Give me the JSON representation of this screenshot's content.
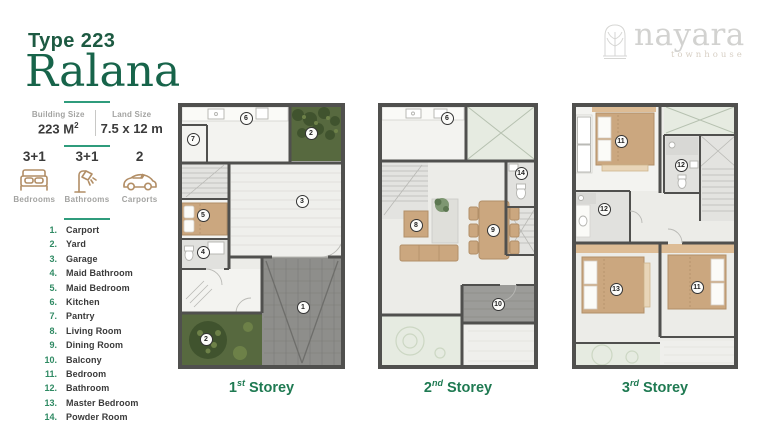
{
  "header": {
    "type_label": "Type 223",
    "name": "Ralana"
  },
  "logo": {
    "brand": "nayara",
    "sub": "townhouse",
    "icon": "arch-tree-emblem-icon"
  },
  "specs": {
    "building_size_label": "Building Size",
    "building_size_value": "223 M",
    "building_size_sup": "2",
    "land_size_label": "Land Size",
    "land_size_value": "7.5 x 12 m"
  },
  "features": [
    {
      "value": "3+1",
      "label": "Bedrooms",
      "icon": "bed-icon"
    },
    {
      "value": "3+1",
      "label": "Bathrooms",
      "icon": "shower-icon"
    },
    {
      "value": "2",
      "label": "Carports",
      "icon": "car-icon"
    }
  ],
  "legend": [
    {
      "num": "1.",
      "label": "Carport"
    },
    {
      "num": "2.",
      "label": "Yard"
    },
    {
      "num": "3.",
      "label": "Garage"
    },
    {
      "num": "4.",
      "label": "Maid Bathroom"
    },
    {
      "num": "5.",
      "label": "Maid Bedroom"
    },
    {
      "num": "6.",
      "label": "Kitchen"
    },
    {
      "num": "7.",
      "label": "Pantry"
    },
    {
      "num": "8.",
      "label": "Living Room"
    },
    {
      "num": "9.",
      "label": "Dining Room"
    },
    {
      "num": "10.",
      "label": "Balcony"
    },
    {
      "num": "11.",
      "label": "Bedroom"
    },
    {
      "num": "12.",
      "label": "Bathroom"
    },
    {
      "num": "13.",
      "label": "Master Bedroom"
    },
    {
      "num": "14.",
      "label": "Powder Room"
    }
  ],
  "plans": [
    {
      "ordinal": "1",
      "suffix": "st",
      "word": "Storey",
      "markers": [
        {
          "n": "7",
          "x": 15,
          "y": 36
        },
        {
          "n": "6",
          "x": 68,
          "y": 15
        },
        {
          "n": "2",
          "x": 133,
          "y": 30
        },
        {
          "n": "3",
          "x": 124,
          "y": 98
        },
        {
          "n": "5",
          "x": 25,
          "y": 112
        },
        {
          "n": "4",
          "x": 25,
          "y": 149
        },
        {
          "n": "1",
          "x": 125,
          "y": 204
        },
        {
          "n": "2",
          "x": 28,
          "y": 236
        }
      ]
    },
    {
      "ordinal": "2",
      "suffix": "nd",
      "word": "Storey",
      "markers": [
        {
          "n": "6",
          "x": 69,
          "y": 15
        },
        {
          "n": "14",
          "x": 143,
          "y": 70
        },
        {
          "n": "8",
          "x": 38,
          "y": 122
        },
        {
          "n": "9",
          "x": 115,
          "y": 127
        },
        {
          "n": "10",
          "x": 120,
          "y": 201
        }
      ]
    },
    {
      "ordinal": "3",
      "suffix": "rd",
      "word": "Storey",
      "markers": [
        {
          "n": "11",
          "x": 49,
          "y": 38
        },
        {
          "n": "12",
          "x": 109,
          "y": 62
        },
        {
          "n": "12",
          "x": 32,
          "y": 106
        },
        {
          "n": "13",
          "x": 44,
          "y": 186
        },
        {
          "n": "11",
          "x": 125,
          "y": 184
        }
      ]
    }
  ],
  "colors": {
    "brand_green": "#17644a",
    "divider_teal": "#2f9c7c",
    "legend_green": "#2f8a63",
    "icon_tan": "#b28e66",
    "wall_gray": "#50504e",
    "furniture_tan": "#CBA77F",
    "yard_green": "#57693f"
  }
}
